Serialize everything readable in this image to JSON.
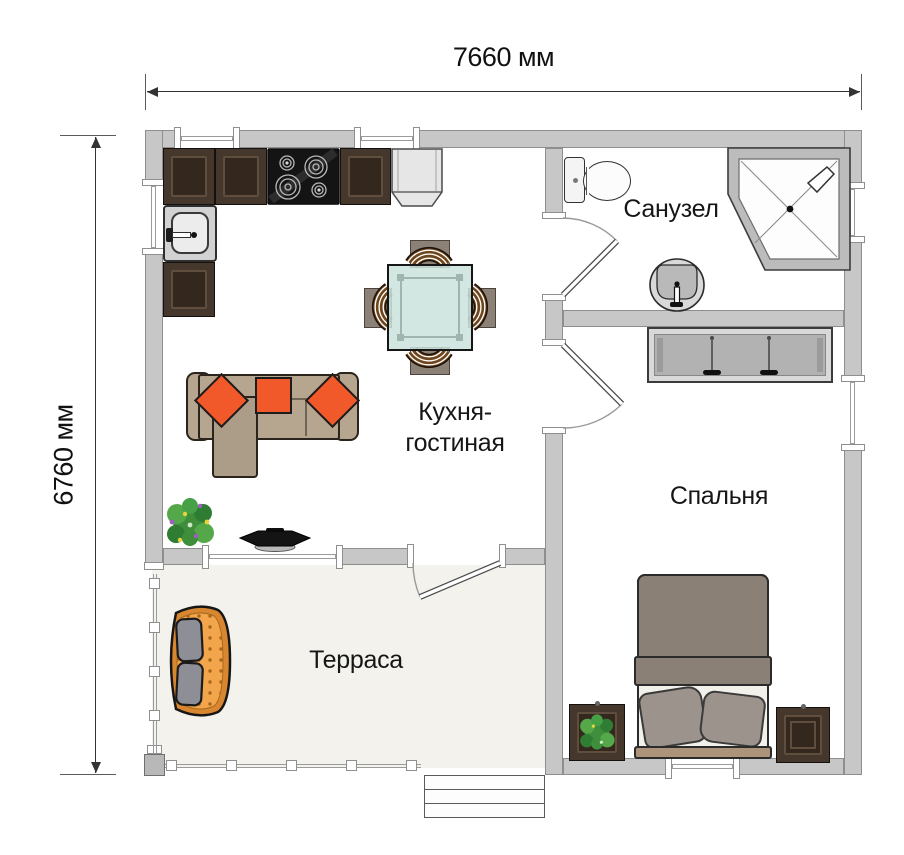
{
  "dimensions": {
    "width": "7660 мм",
    "height": "6760 мм"
  },
  "rooms": {
    "kitchen_living": {
      "line1": "Кухня-",
      "line2": "гостиная"
    },
    "bathroom": "Санузел",
    "bedroom": "Спальня",
    "terrace": "Терраса"
  },
  "icons": {
    "stove": "4-burner cooktop",
    "kitchen_sink": "kitchen sink",
    "fridge": "refrigerator",
    "dining_table": "square glass table with 4 chairs",
    "sofa": "corner sofa with 3 pillows",
    "tv": "tv on stand",
    "plant": "potted flowering plant",
    "toilet": "toilet",
    "washbasin": "washbasin",
    "shower": "corner shower cabin",
    "wardrobe": "sliding-door wardrobe",
    "bed": "double bed with 2 pillows",
    "nightstand": "nightstand",
    "terrace_sofa": "outdoor loveseat with 2 cushions",
    "steps": "entrance steps",
    "railing": "terrace railing",
    "window": "window",
    "door": "swing door"
  },
  "colors": {
    "wall-fill": "#c7c7c7",
    "wall-stroke": "#8e8e8e",
    "terrace-floor": "#f3f2ec",
    "cabinet": "#46372c",
    "cabinet-inset": "#33271e",
    "cabinet-edge": "#5f4d3e",
    "sofa": "#b6a68f",
    "chaise": "#ab9d88",
    "pillow": "#f2592a",
    "glass": "rgba(203,227,221,0.85)",
    "chair-wood": "#6f451c",
    "blanket": "#8b8076",
    "bed-pillow": "#9c938c",
    "headboard": "#ab947a",
    "sheet": "#f2f0ea",
    "wardrobe": "#b2b2b2",
    "terrace-sofa-rim": "#d8862f",
    "terrace-sofa-seat": "#f2a54b",
    "cushion": "#8e8e96",
    "text": "#161616"
  }
}
